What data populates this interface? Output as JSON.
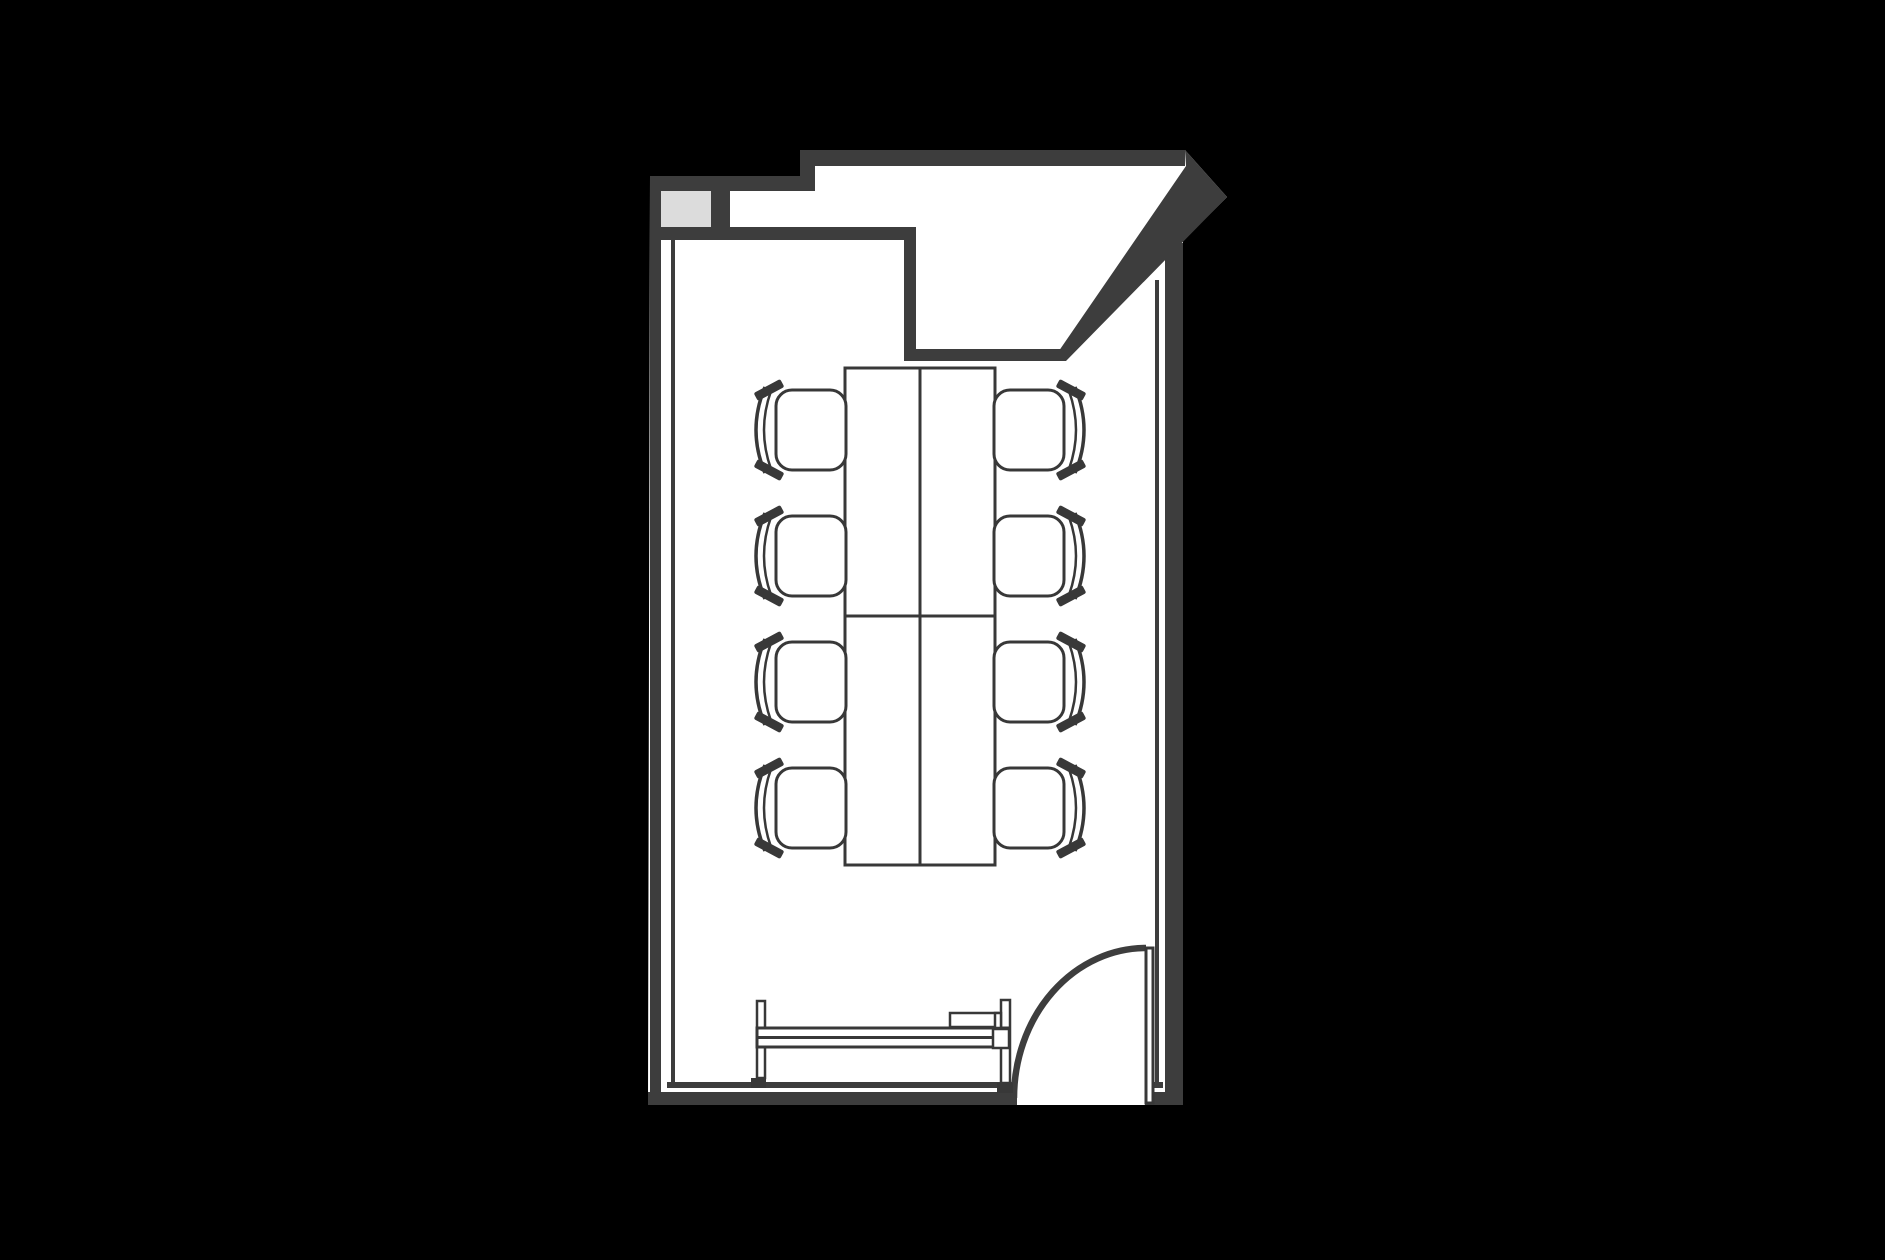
{
  "scene": {
    "kind": "architectural-floor-plan",
    "room_label": "meeting-room",
    "text_content": "none"
  },
  "palette": {
    "background": "#000000",
    "wall": "#3d3d3d",
    "furniture_line": "#383838",
    "interior": "#ffffff",
    "column_fill": "#dcdcdc"
  },
  "room": {
    "walls": [
      "top-left-wall",
      "top-wall",
      "angled-vestibule-wall",
      "vestibule-step-wall",
      "inner-top-wall",
      "left-wall",
      "right-wall",
      "bottom-wall"
    ],
    "column_block": {
      "position": "top-left",
      "fill": "#dcdcdc"
    },
    "door": {
      "type": "single-swing",
      "position": "bottom-right",
      "swing": "opens-into-room",
      "leaf_count": 1
    }
  },
  "furniture": {
    "table": {
      "type": "conference-table",
      "sections": 4,
      "columns": 2,
      "rows": 2,
      "center_x": 920,
      "top": 368,
      "bottom": 865,
      "left": 845,
      "right": 995,
      "split_y": 616
    },
    "chairs": {
      "count": 8,
      "per_side": 4,
      "sides": [
        "left",
        "right"
      ],
      "row_centers": [
        430,
        556,
        682,
        808
      ],
      "mirror_axis_x": 920
    },
    "credenza": {
      "type": "sideboard-with-rails",
      "position": "bottom-wall",
      "posts": 2,
      "rail_lines": 3
    }
  }
}
